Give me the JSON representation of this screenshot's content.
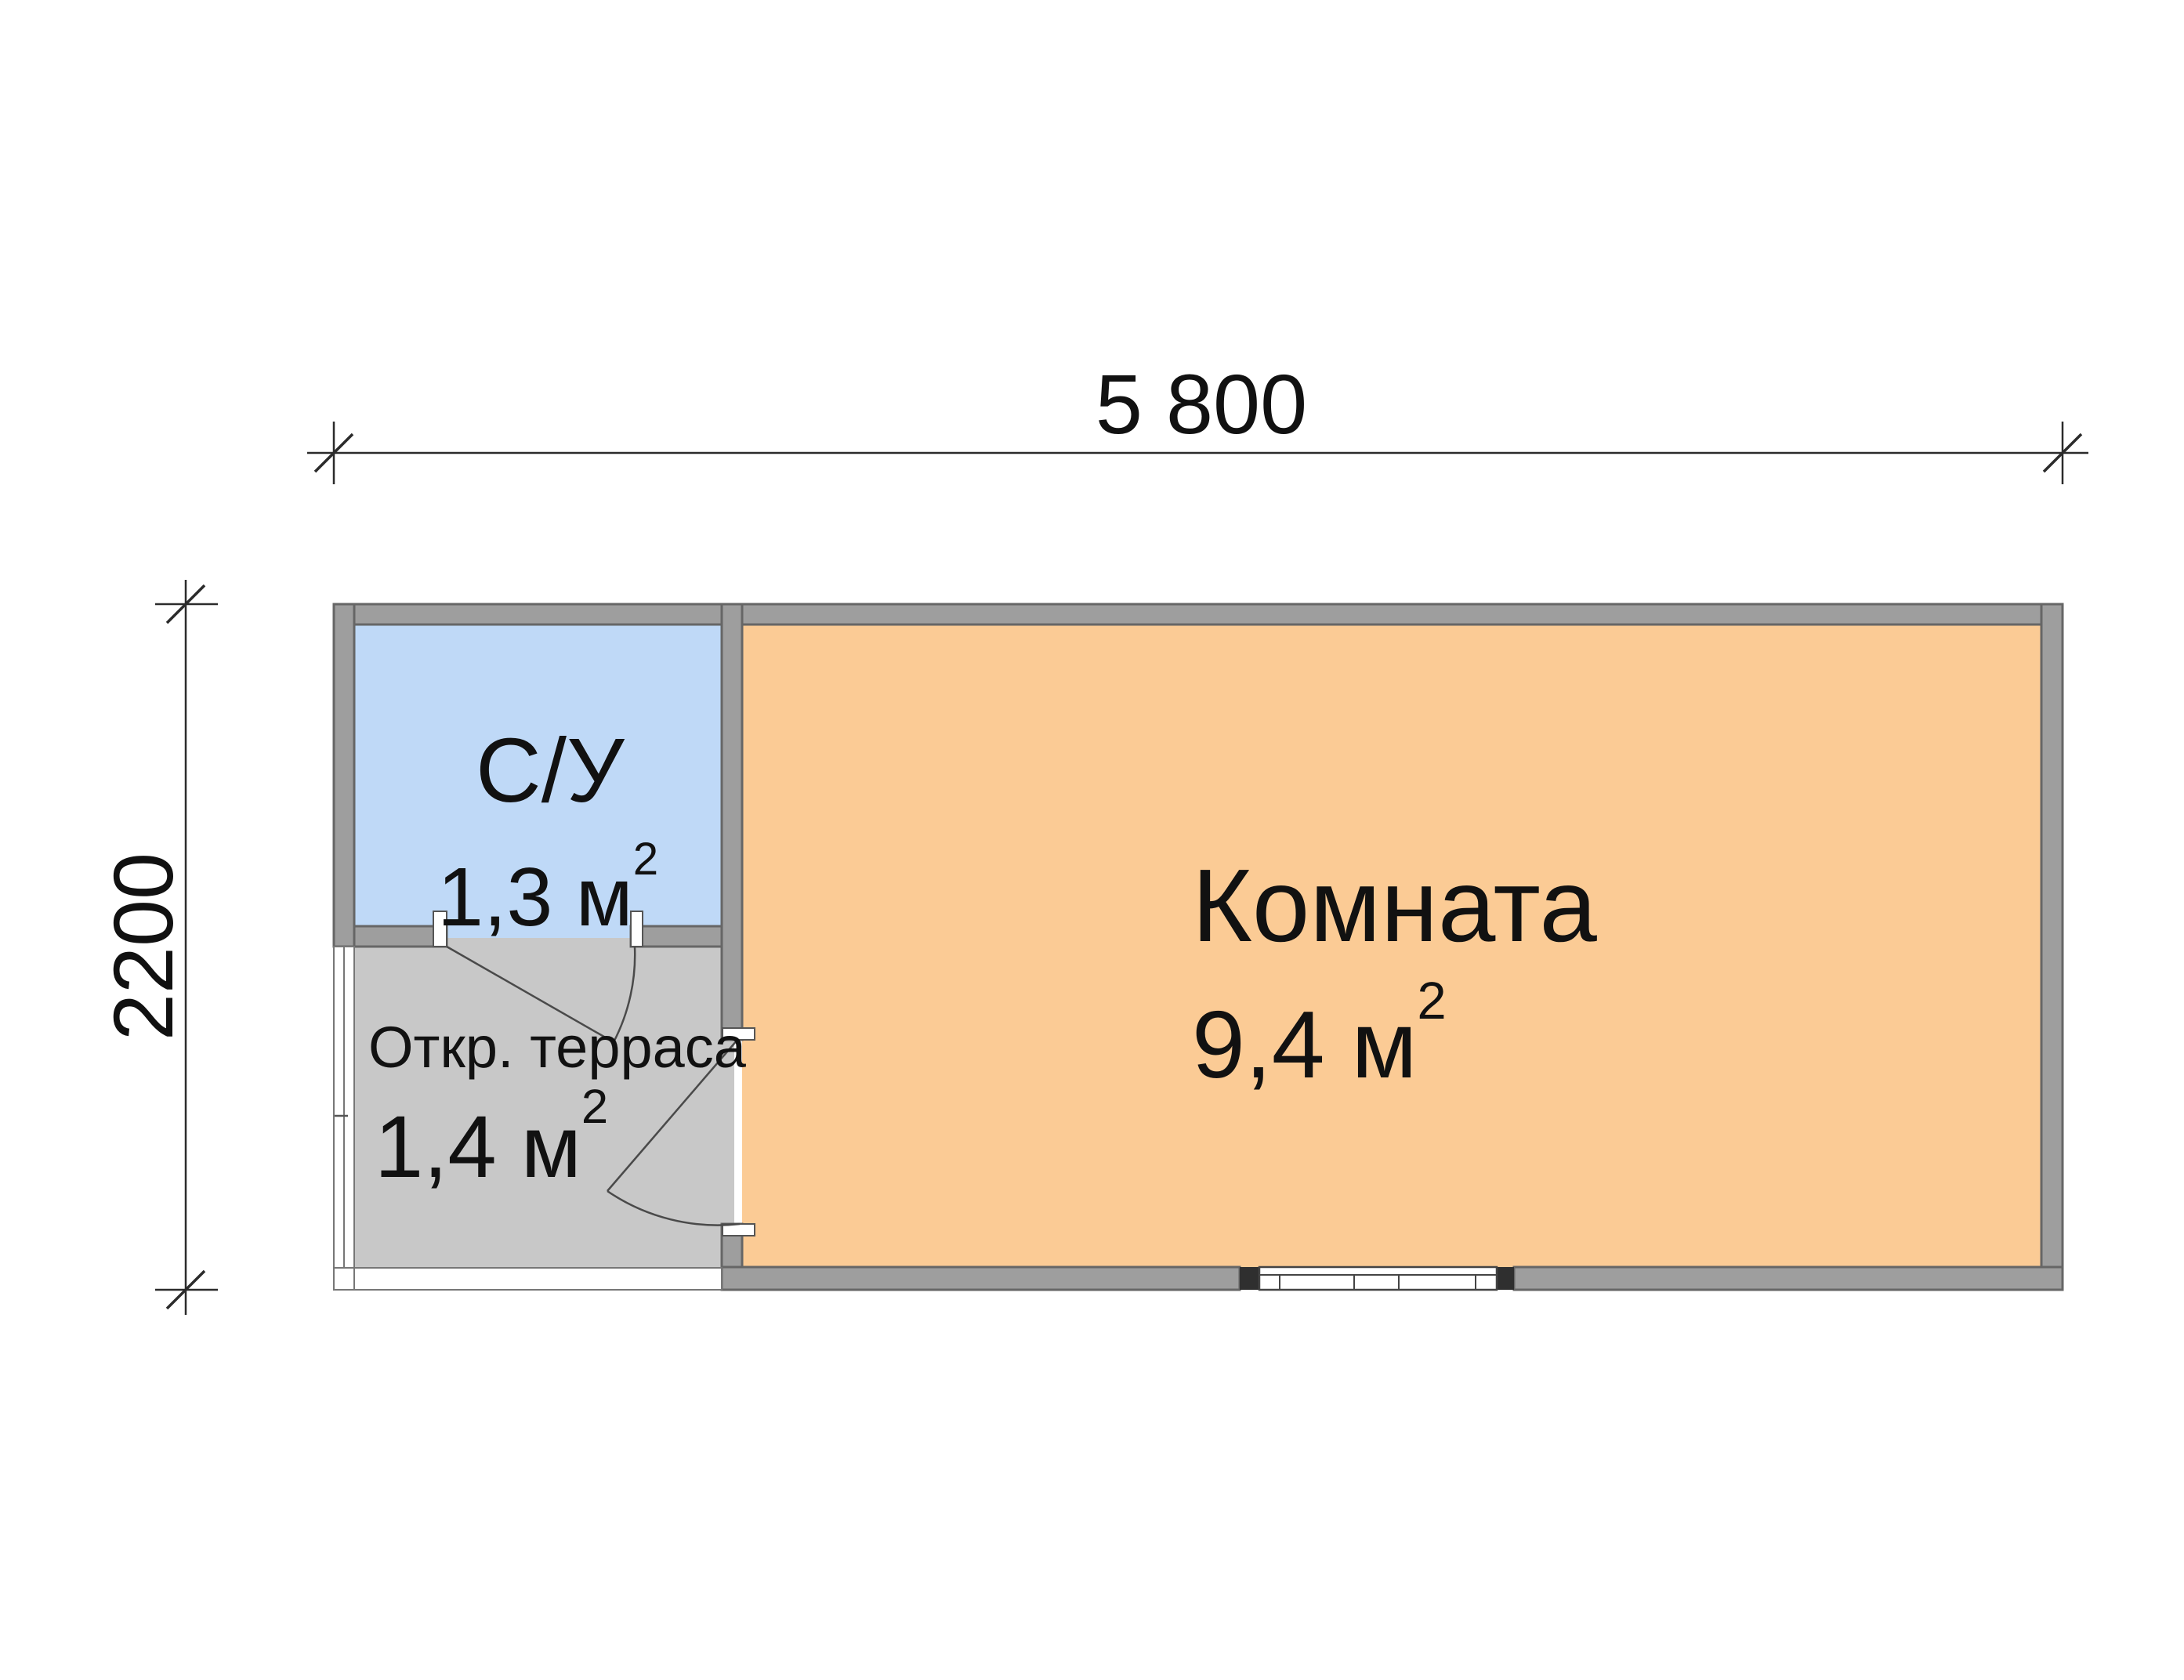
{
  "plan": {
    "dimensions": {
      "width": {
        "label": "5 800"
      },
      "height": {
        "label": "2200"
      }
    },
    "rooms": {
      "bathroom": {
        "name": "С/У",
        "area": "1,3 м",
        "area_sup": "2",
        "fill": "#BFD9F7"
      },
      "terrace": {
        "name": "Откр. терраса",
        "area": "1,4 м",
        "area_sup": "2",
        "fill": "#C8C8C8"
      },
      "living": {
        "name": "Комната",
        "area": "9,4 м",
        "area_sup": "2",
        "fill": "#FBCB95"
      }
    },
    "colors": {
      "wall": "#9E9E9E",
      "wall_outline": "#666666",
      "open_edge_outline": "#777777",
      "door_line": "#4A4A4A",
      "window_cap": "#2F2F2F",
      "dimension_line": "#2B2B2B",
      "text": "#111111",
      "background": "#FFFFFF"
    }
  }
}
